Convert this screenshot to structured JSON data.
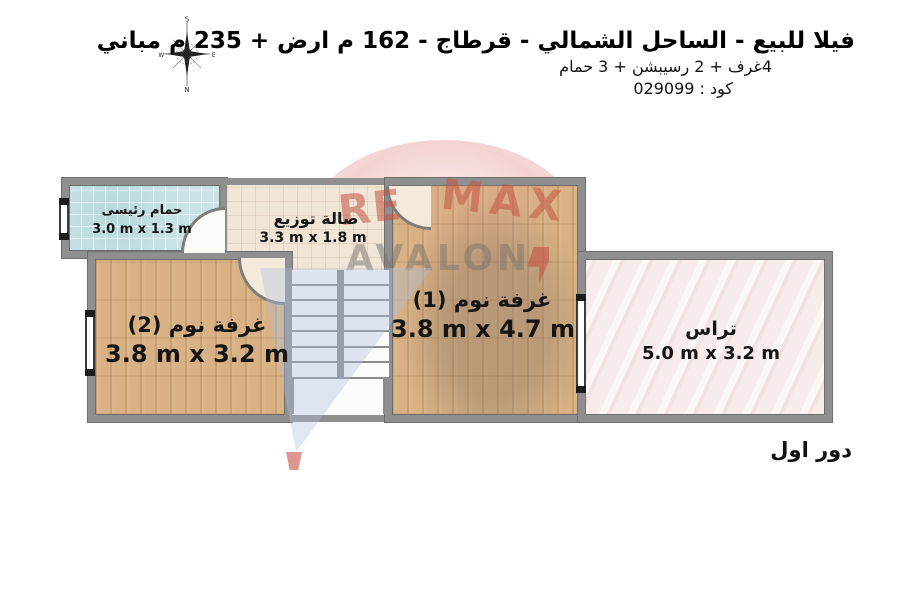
{
  "header": {
    "title": "فيلا للبيع - الساحل الشمالي - قرطاج - 162 م ارض + 235 م مباني",
    "subtitle": "4غرف + 2 رسيبشن + 3 حمام",
    "code": "كود : 029099"
  },
  "compass": {
    "top": "S",
    "right": "E",
    "bottom": "N",
    "left": "W"
  },
  "watermark": {
    "brand_line1_part1": "RE",
    "brand_line1_part2": "MAX",
    "brand_line2": "AVALON",
    "red": "#c65442",
    "gray": "#7a736c",
    "blue": "#adc0dc",
    "pink": "#e8a5a5"
  },
  "plan": {
    "rooms": [
      {
        "id": "bathroom",
        "name": "حمام رئيسى",
        "dims": "3.0 m x 1.3 m"
      },
      {
        "id": "hall",
        "name": "صالة توزيع",
        "dims": "3.3 m x 1.8 m"
      },
      {
        "id": "bedroom2",
        "name": "غرفة نوم (2)",
        "dims": "3.8 m x 3.2 m"
      },
      {
        "id": "bedroom1",
        "name": "غرفة نوم (1)",
        "dims": "3.8 m x 4.7 m"
      },
      {
        "id": "terrace",
        "name": "تراس",
        "dims": "5.0 m x 3.2 m"
      }
    ],
    "floor_label": "دور اول"
  },
  "colors": {
    "wall": "#8f8f8f",
    "wall_edge": "#6e6e6e",
    "bathroom_floor": "#c9e3e4",
    "hall_floor": "#f1e5d6",
    "wood_floor": "#d8b184",
    "terrace_floor": "#f6eceb",
    "stair_tread": "#fbfbfb"
  }
}
